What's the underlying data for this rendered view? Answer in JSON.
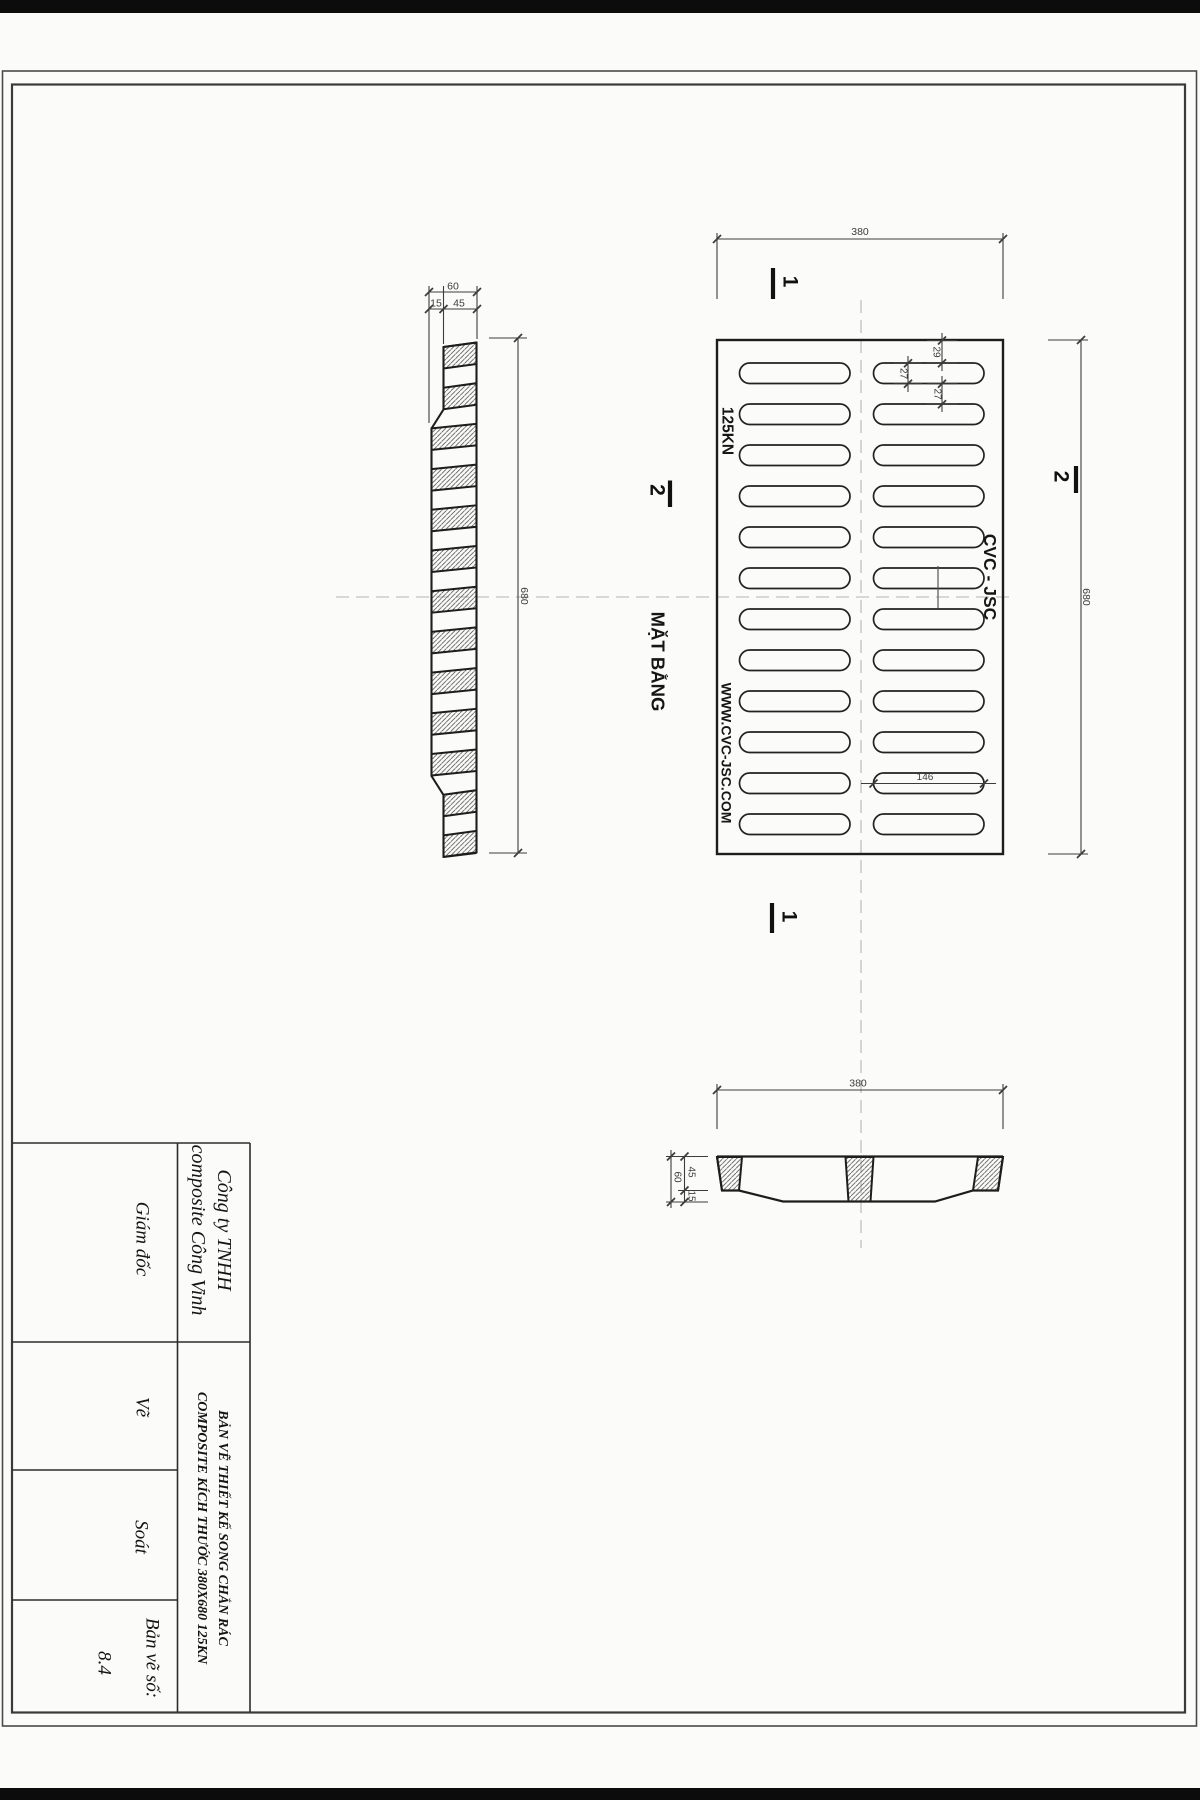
{
  "appearance": {
    "paper": "#fbfbf9",
    "ink": "#1d1d1d",
    "dim_ink": "#3c3c3c",
    "centerline": "#b5b5b5",
    "scan_band": "#0c0c0c",
    "frame": "#4a4a4a"
  },
  "drawing": {
    "plan": {
      "slots_per_column": 12,
      "label": "MẶT BẰNG",
      "load_rating": "125KN",
      "brand": "CVC - JSC",
      "website": "WWW.CVC-JSC.COM"
    },
    "side_section": {
      "bars": 13
    },
    "section_markers": {
      "one": "1",
      "two": "2"
    },
    "dims": {
      "width": "380",
      "length": "680",
      "total_depth": "60",
      "web": "15",
      "rib": "45",
      "end_margin": "29",
      "slot_w": "27",
      "slot_gap": "27",
      "slot_len": "146"
    }
  },
  "title_block": {
    "company": "Công ty TNHH\ncomposite Công Vinh",
    "director_label": "Giám đốc",
    "drawn_label": "Vẽ",
    "checked_label": "Soát",
    "drawing_no_label": "Bản vẽ số:",
    "drawing_no": "8.4",
    "title": "BẢN VẼ THIẾT KẾ SONG CHẮN RÁC\nCOMPOSITE KÍCH THƯỚC 380X680  125KN"
  }
}
